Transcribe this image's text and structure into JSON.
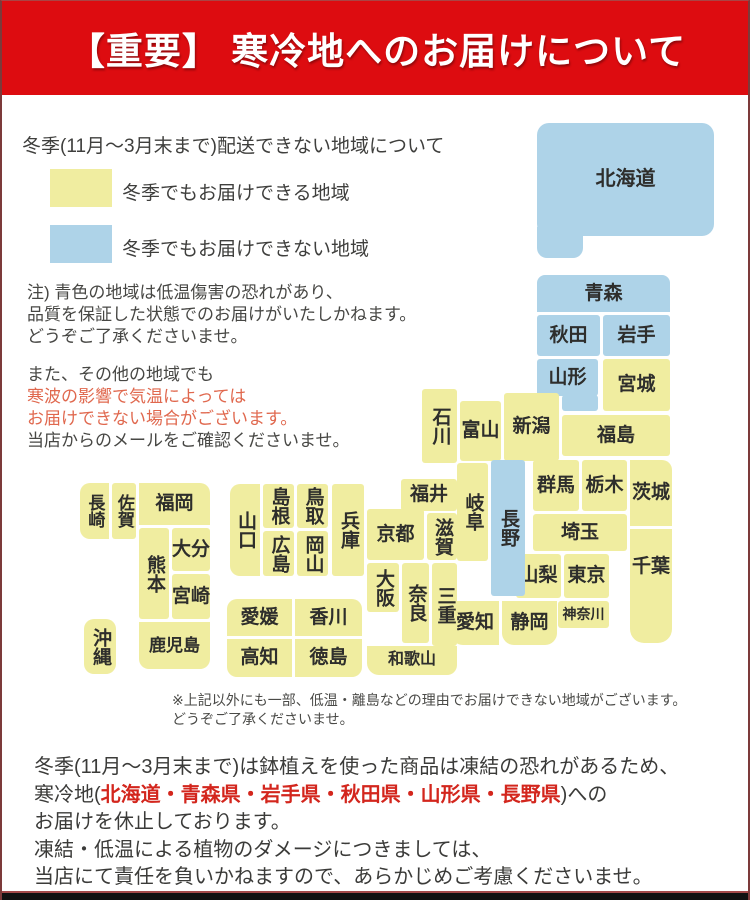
{
  "header": {
    "title": "【重要】 寒冷地へのお届けについて"
  },
  "legend": {
    "title": "冬季(11月～3月末まで)配送できない地域について",
    "items": [
      {
        "label": "冬季でもお届けできる地域",
        "type": "ok"
      },
      {
        "label": "冬季でもお届けできない地域",
        "type": "ng"
      }
    ]
  },
  "notes": {
    "note1_lines": [
      "注) 青色の地域は低温傷害の恐れがあり、",
      "品質を保証した状態でのお届けがいたしかねます。",
      "どうぞご了承くださいませ。"
    ],
    "note2_lines": [
      {
        "text": "また、その他の地域でも",
        "red": false
      },
      {
        "text": "寒波の影響で気温によっては",
        "red": true
      },
      {
        "text": "お届けできない場合がございます。",
        "red": true
      },
      {
        "text": "当店からのメールをご確認くださいませ。",
        "red": false
      }
    ]
  },
  "colors": {
    "banner_bg": "#dd0c10",
    "ok_fill": "#f0eda0",
    "ng_fill": "#aed3e8",
    "soft_red_text": "#e0684e",
    "strong_red_text": "#d3261d",
    "body_text": "#3f3f3d"
  },
  "map": {
    "legend_ok_meaning": "冬季でもお届けできる地域",
    "legend_ng_meaning": "冬季でもお届けできない地域",
    "regions": [
      {
        "name": "hokkaido",
        "label": "北海道",
        "status": "ng",
        "x": 535,
        "y": 122,
        "w": 177,
        "h": 113,
        "r": "12px",
        "fs": 20
      },
      {
        "name": "hokkaido-tab",
        "label": "",
        "status": "ng",
        "x": 535,
        "y": 226,
        "w": 46,
        "h": 31,
        "r": "0 0 10px 10px"
      },
      {
        "name": "aomori",
        "label": "青森",
        "status": "ng",
        "x": 535,
        "y": 274,
        "w": 133,
        "h": 37,
        "r": "8px 8px 0 0"
      },
      {
        "name": "akita",
        "label": "秋田",
        "status": "ng",
        "x": 535,
        "y": 314,
        "w": 63,
        "h": 41
      },
      {
        "name": "iwate",
        "label": "岩手",
        "status": "ng",
        "x": 601,
        "y": 314,
        "w": 67,
        "h": 41
      },
      {
        "name": "yamagata",
        "label": "山形",
        "status": "ng",
        "x": 535,
        "y": 358,
        "w": 61,
        "h": 37
      },
      {
        "name": "yamagata-tab",
        "label": "",
        "status": "ng",
        "x": 560,
        "y": 394,
        "w": 36,
        "h": 16
      },
      {
        "name": "miyagi",
        "label": "宮城",
        "status": "ok",
        "x": 601,
        "y": 358,
        "w": 67,
        "h": 52
      },
      {
        "name": "fukushima",
        "label": "福島",
        "status": "ok",
        "x": 560,
        "y": 414,
        "w": 108,
        "h": 41
      },
      {
        "name": "niigata",
        "label": "新潟",
        "status": "ok",
        "x": 502,
        "y": 392,
        "w": 55,
        "h": 68
      },
      {
        "name": "toyama",
        "label": "富山",
        "status": "ok",
        "x": 458,
        "y": 400,
        "w": 41,
        "h": 60
      },
      {
        "name": "ishikawa",
        "label": "石川",
        "status": "ok",
        "v": true,
        "x": 420,
        "y": 388,
        "w": 35,
        "h": 74
      },
      {
        "name": "fukui",
        "label": "福井",
        "status": "ok",
        "x": 399,
        "y": 478,
        "w": 56,
        "h": 32
      },
      {
        "name": "gunma",
        "label": "群馬",
        "status": "ok",
        "x": 531,
        "y": 459,
        "w": 46,
        "h": 51
      },
      {
        "name": "tochigi",
        "label": "栃木",
        "status": "ok",
        "x": 580,
        "y": 459,
        "w": 45,
        "h": 51
      },
      {
        "name": "ibaraki",
        "label": "茨城",
        "status": "ok",
        "x": 628,
        "y": 459,
        "w": 42,
        "h": 66,
        "r": "0 10px 0 0"
      },
      {
        "name": "saitama",
        "label": "埼玉",
        "status": "ok",
        "x": 531,
        "y": 513,
        "w": 94,
        "h": 37
      },
      {
        "name": "yamanashi",
        "label": "山梨",
        "status": "ok",
        "x": 514,
        "y": 553,
        "w": 45,
        "h": 44
      },
      {
        "name": "tokyo",
        "label": "東京",
        "status": "ok",
        "x": 562,
        "y": 553,
        "w": 45,
        "h": 44
      },
      {
        "name": "chiba",
        "label": "千葉",
        "status": "ok",
        "x": 628,
        "y": 528,
        "w": 42,
        "h": 114,
        "r": "0 0 14px 14px",
        "pt": 28
      },
      {
        "name": "kanagawa",
        "label": "神奈川",
        "status": "ok",
        "x": 556,
        "y": 600,
        "w": 51,
        "h": 27,
        "fs": 14
      },
      {
        "name": "shizuoka",
        "label": "静岡",
        "status": "ok",
        "x": 500,
        "y": 600,
        "w": 55,
        "h": 44,
        "r": "0 0 12px 12px"
      },
      {
        "name": "aichi",
        "label": "愛知",
        "status": "ok",
        "x": 449,
        "y": 600,
        "w": 48,
        "h": 44,
        "r": "0 0 0 12px"
      },
      {
        "name": "nagano",
        "label": "長野",
        "status": "ng",
        "v": true,
        "x": 489,
        "y": 459,
        "w": 34,
        "h": 136
      },
      {
        "name": "gifu",
        "label": "岐阜",
        "status": "ok",
        "v": true,
        "x": 455,
        "y": 462,
        "w": 31,
        "h": 98
      },
      {
        "name": "shiga",
        "label": "滋賀",
        "status": "ok",
        "v": true,
        "x": 425,
        "y": 512,
        "w": 30,
        "h": 47
      },
      {
        "name": "kyoto",
        "label": "京都",
        "status": "ok",
        "x": 365,
        "y": 508,
        "w": 57,
        "h": 51
      },
      {
        "name": "hyogo",
        "label": "兵庫",
        "status": "ok",
        "v": true,
        "x": 330,
        "y": 483,
        "w": 32,
        "h": 92
      },
      {
        "name": "osaka",
        "label": "大阪",
        "status": "ok",
        "v": true,
        "x": 365,
        "y": 562,
        "w": 32,
        "h": 49
      },
      {
        "name": "nara",
        "label": "奈良",
        "status": "ok",
        "v": true,
        "x": 400,
        "y": 562,
        "w": 27,
        "h": 80
      },
      {
        "name": "mie",
        "label": "三重",
        "status": "ok",
        "v": true,
        "x": 430,
        "y": 562,
        "w": 25,
        "h": 83
      },
      {
        "name": "wakayama",
        "label": "和歌山",
        "status": "ok",
        "x": 365,
        "y": 645,
        "w": 90,
        "h": 29,
        "r": "0 0 10px 12px",
        "fs": 16
      },
      {
        "name": "yamaguchi",
        "label": "山口",
        "status": "ok",
        "v": true,
        "x": 228,
        "y": 483,
        "w": 30,
        "h": 92,
        "r": "10px 0 0 10px"
      },
      {
        "name": "shimane",
        "label": "島根",
        "status": "ok",
        "v": true,
        "x": 261,
        "y": 483,
        "w": 31,
        "h": 44
      },
      {
        "name": "tottori",
        "label": "鳥取",
        "status": "ok",
        "v": true,
        "x": 295,
        "y": 483,
        "w": 31,
        "h": 44
      },
      {
        "name": "hiroshima",
        "label": "広島",
        "status": "ok",
        "v": true,
        "x": 261,
        "y": 530,
        "w": 31,
        "h": 45
      },
      {
        "name": "okayama",
        "label": "岡山",
        "status": "ok",
        "v": true,
        "x": 295,
        "y": 530,
        "w": 31,
        "h": 45
      },
      {
        "name": "ehime",
        "label": "愛媛",
        "status": "ok",
        "x": 225,
        "y": 598,
        "w": 65,
        "h": 37,
        "r": "10px 0 0 0"
      },
      {
        "name": "kagawa",
        "label": "香川",
        "status": "ok",
        "x": 293,
        "y": 598,
        "w": 67,
        "h": 37,
        "r": "0 10px 0 0"
      },
      {
        "name": "kochi",
        "label": "高知",
        "status": "ok",
        "x": 225,
        "y": 638,
        "w": 65,
        "h": 38,
        "r": "0 0 0 10px"
      },
      {
        "name": "tokushima",
        "label": "徳島",
        "status": "ok",
        "x": 293,
        "y": 638,
        "w": 67,
        "h": 38,
        "r": "0 0 10px 0"
      },
      {
        "name": "nagasaki",
        "label": "長崎",
        "status": "ok",
        "v": true,
        "x": 78,
        "y": 482,
        "w": 29,
        "h": 56,
        "r": "10px 0 0 10px",
        "fs": 17
      },
      {
        "name": "saga",
        "label": "佐賀",
        "status": "ok",
        "v": true,
        "x": 110,
        "y": 482,
        "w": 24,
        "h": 56,
        "fs": 17
      },
      {
        "name": "fukuoka",
        "label": "福岡",
        "status": "ok",
        "x": 137,
        "y": 482,
        "w": 71,
        "h": 42,
        "r": "0 10px 0 0"
      },
      {
        "name": "kumamoto",
        "label": "熊本",
        "status": "ok",
        "v": true,
        "x": 137,
        "y": 527,
        "w": 30,
        "h": 91
      },
      {
        "name": "oita",
        "label": "大分",
        "status": "ok",
        "x": 170,
        "y": 527,
        "w": 38,
        "h": 43
      },
      {
        "name": "miyazaki",
        "label": "宮崎",
        "status": "ok",
        "x": 170,
        "y": 573,
        "w": 38,
        "h": 45
      },
      {
        "name": "kagoshima",
        "label": "鹿児島",
        "status": "ok",
        "x": 137,
        "y": 621,
        "w": 71,
        "h": 47,
        "r": "0 0 10px 10px",
        "fs": 17
      },
      {
        "name": "okinawa",
        "label": "沖縄",
        "status": "ok",
        "v": true,
        "x": 82,
        "y": 618,
        "w": 32,
        "h": 55,
        "r": "10px"
      }
    ]
  },
  "footnote": {
    "line1": "※上記以外にも一部、低温・離島などの理由でお届けできない地域がございます。",
    "line2": "どうぞご了承くださいませ。"
  },
  "footer": {
    "line1": "冬季(11月～3月末まで)は鉢植えを使った商品は凍結の恐れがあるため、",
    "line2_prefix": "寒冷地(",
    "line2_red": "北海道・青森県・岩手県・秋田県・山形県・長野県",
    "line2_suffix": ")への",
    "line3": "お届けを休止しております。",
    "line4": "凍結・低温による植物のダメージにつきましては、",
    "line5": "当店にて責任を負いかねますので、あらかじめご考慮くださいませ。"
  }
}
